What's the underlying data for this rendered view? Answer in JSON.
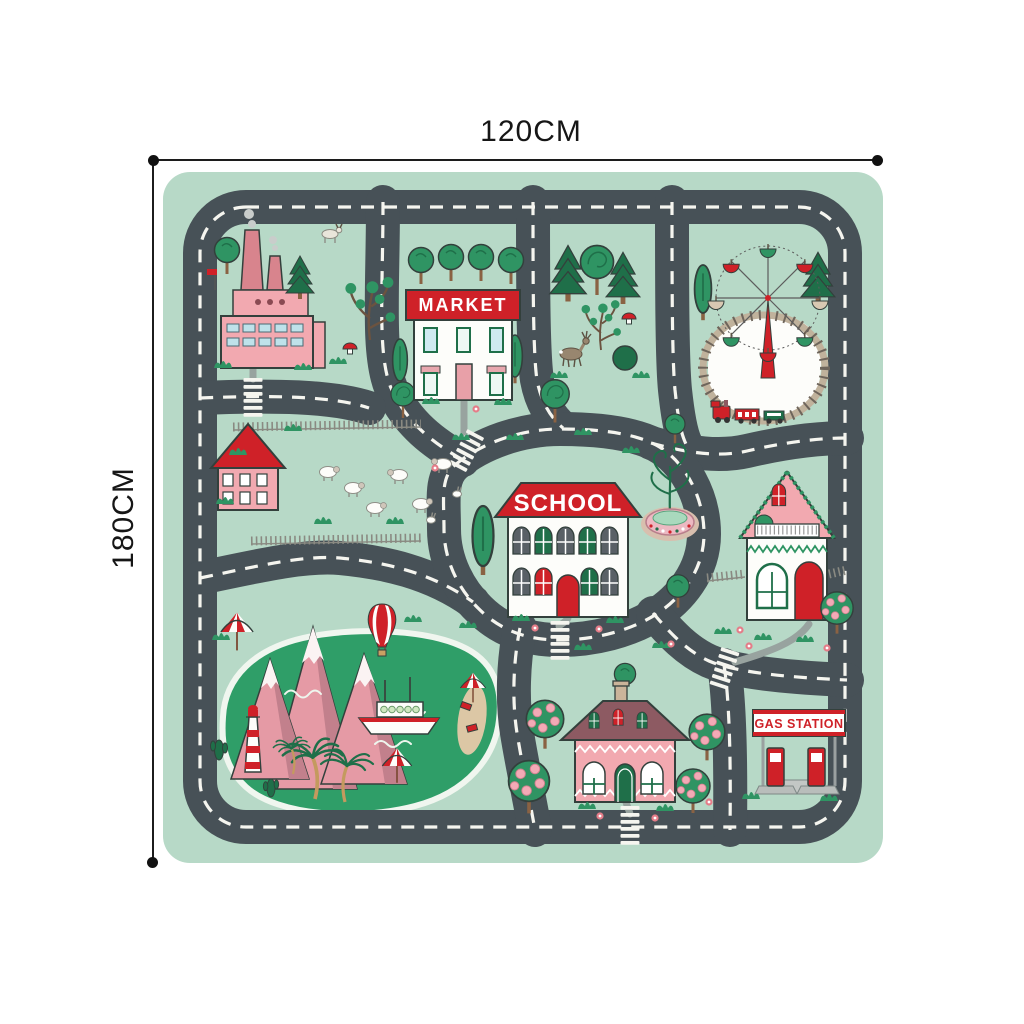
{
  "page": {
    "background": "#ffffff"
  },
  "dimensions": {
    "width_label": "120CM",
    "height_label": "180CM"
  },
  "signs": {
    "market": "MARKET",
    "school": "SCHOOL",
    "gas_station": "GAS STATION"
  },
  "illustrations": [
    "factory",
    "market",
    "forest-with-deer",
    "ferris-wheel-with-train",
    "farm-with-sheep",
    "school-with-fountain",
    "cottage",
    "lake-with-mountains",
    "lighthouse",
    "ship",
    "palm-trees",
    "hot-air-balloon",
    "orchard-house",
    "gas-station"
  ],
  "colors": {
    "matbg": "#b7d9c7",
    "road": "#475157",
    "dash": "#f5f5ef",
    "outline": "#33403c",
    "red": "#cf2128",
    "pink": "#f2a9b0",
    "pinkdark": "#d8848d",
    "mauve": "#8d5a62",
    "greendark": "#1f6f49",
    "green": "#2f9463",
    "lake": "#2f9e68",
    "white": "#fdfdfa",
    "path": "#98a39f",
    "windowblue": "#bfe2ea",
    "tan": "#cbb49a",
    "trunk": "#8a6243",
    "sand": "#dcc7a5",
    "mtn": "#e59aa5",
    "mtnshade": "#c2808c",
    "deer": "#98866f",
    "apple": "#f3aab6",
    "flower": "#e47d89",
    "basin": "#ecb9c2",
    "water": "#a9d9bd"
  }
}
